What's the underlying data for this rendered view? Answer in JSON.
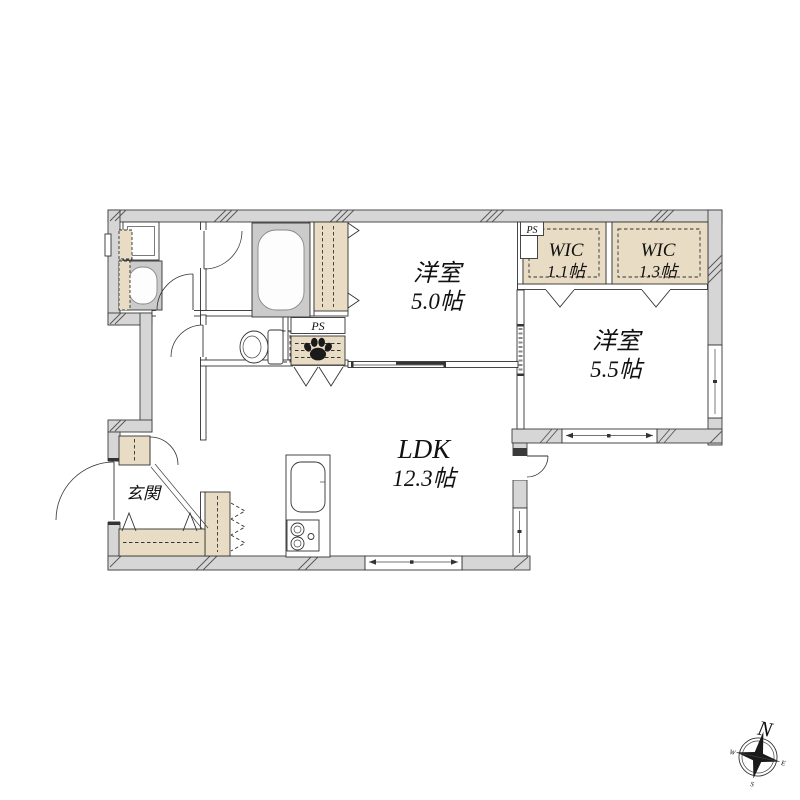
{
  "rooms": {
    "ldk": {
      "name": "LDK",
      "size": "12.3帖"
    },
    "bedroom1": {
      "name": "洋室",
      "size": "5.0帖"
    },
    "bedroom2": {
      "name": "洋室",
      "size": "5.5帖"
    },
    "wic1": {
      "name": "WIC",
      "size": "1.1帖"
    },
    "wic2": {
      "name": "WIC",
      "size": "1.3帖"
    },
    "entrance": {
      "name": "玄関"
    }
  },
  "ps": {
    "label1": "PS",
    "label2": "PS"
  },
  "compass": {
    "north": "N",
    "east": "E",
    "south": "S",
    "west": "W"
  },
  "icons": {
    "paw": "paw-print-icon",
    "compass": "compass-icon"
  },
  "colors": {
    "wall_fill": "#d6d6d6",
    "closet_fill": "#e9dcc4",
    "fixture_fill": "#cbcbcb",
    "line": "#333333",
    "background": "#ffffff"
  }
}
